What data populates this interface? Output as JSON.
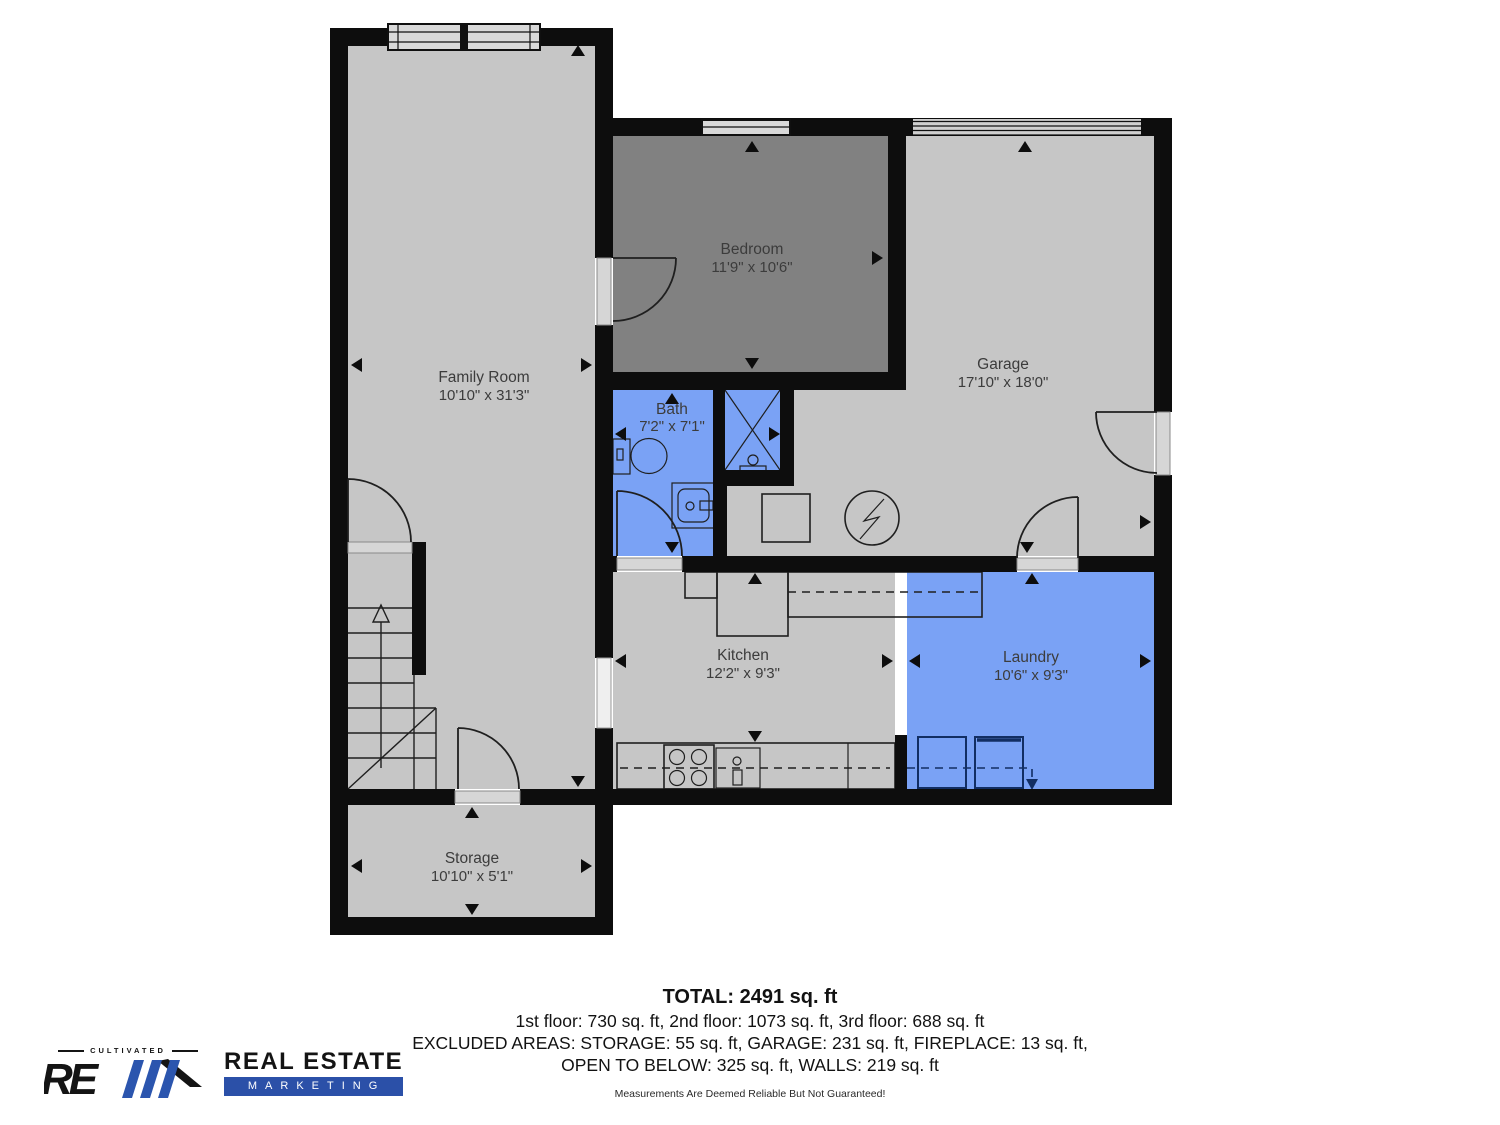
{
  "colors": {
    "wall": "#0d0d0d",
    "floor_gray": "#c6c6c6",
    "bedroom_gray": "#818181",
    "wet_blue": "#7aa2f5",
    "brand_blue": "#2b50a8"
  },
  "rooms": {
    "family": {
      "name": "Family Room",
      "dims": "10'10\" x 31'3\""
    },
    "bedroom": {
      "name": "Bedroom",
      "dims": "11'9\" x 10'6\""
    },
    "garage": {
      "name": "Garage",
      "dims": "17'10\" x 18'0\""
    },
    "bath": {
      "name": "Bath",
      "dims": "7'2\" x 7'1\""
    },
    "kitchen": {
      "name": "Kitchen",
      "dims": "12'2\" x 9'3\""
    },
    "laundry": {
      "name": "Laundry",
      "dims": "10'6\" x 9'3\""
    },
    "storage": {
      "name": "Storage",
      "dims": "10'10\" x 5'1\""
    }
  },
  "summary": {
    "total": "TOTAL: 2491 sq. ft",
    "floors": "1st floor: 730 sq. ft, 2nd floor: 1073 sq. ft, 3rd floor: 688 sq. ft",
    "excluded1": "EXCLUDED AREAS: STORAGE: 55 sq. ft, GARAGE: 231 sq. ft, FIREPLACE: 13 sq. ft,",
    "excluded2": "OPEN TO BELOW: 325 sq. ft, WALLS: 219 sq. ft",
    "disclaimer": "Measurements Are Deemed Reliable But Not Guaranteed!"
  },
  "logo": {
    "tagline": "CULTIVATED",
    "monogram": "RE",
    "name_line1": "REAL ESTATE",
    "name_line2": "MARKETING"
  }
}
